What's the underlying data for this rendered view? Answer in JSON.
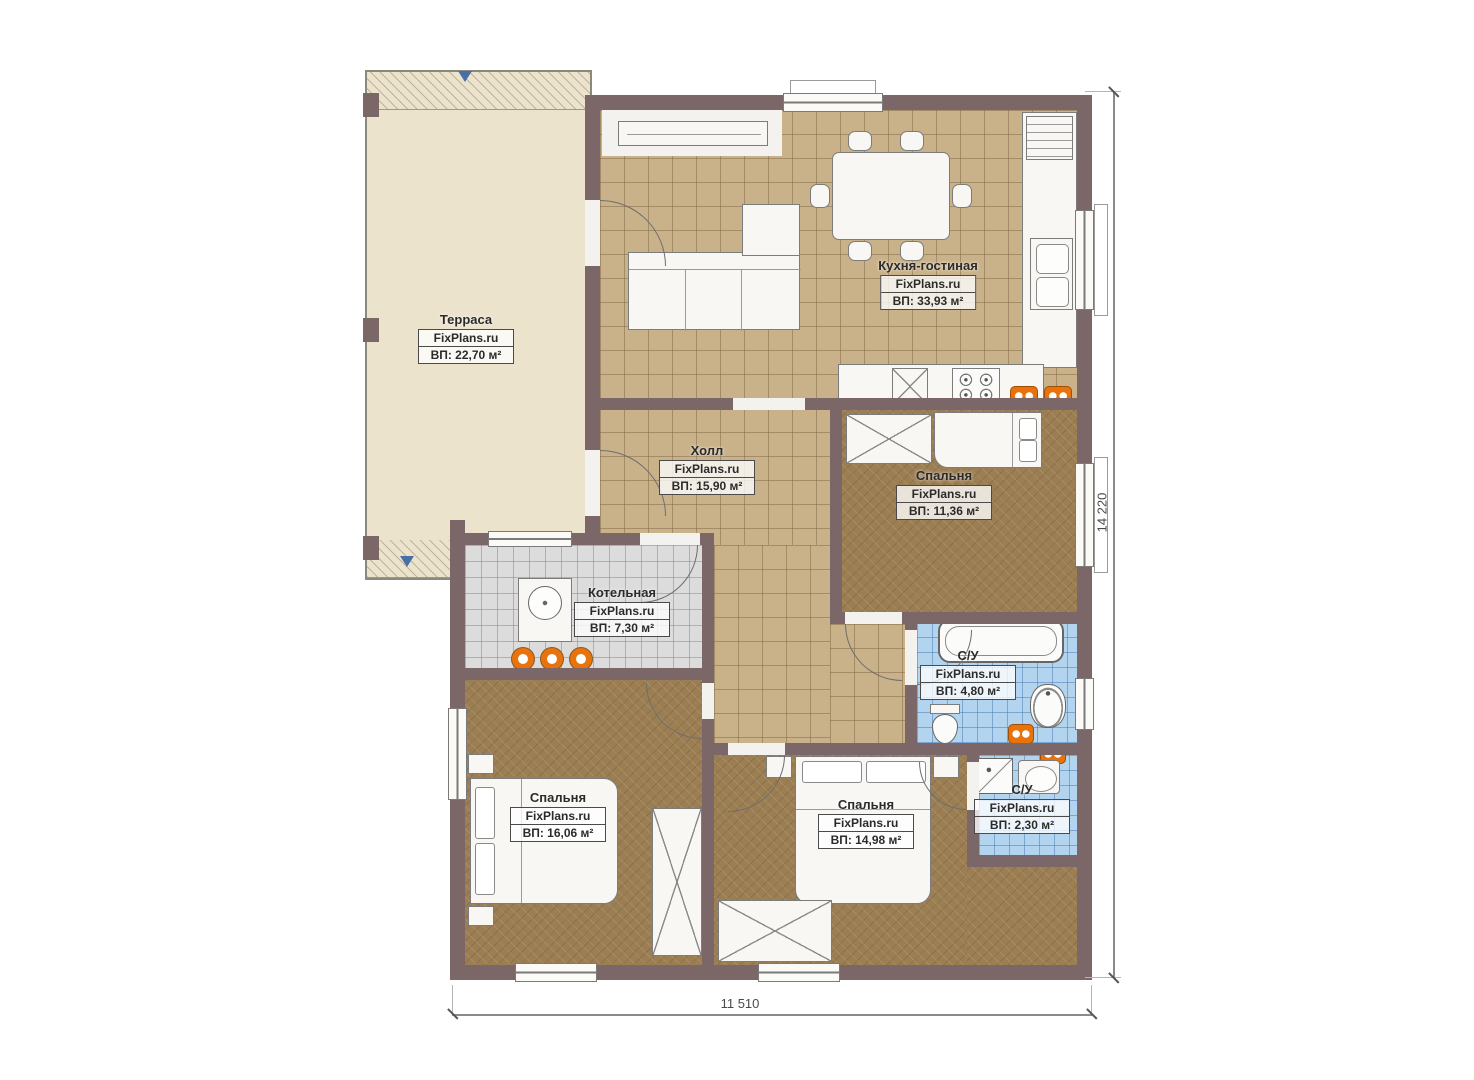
{
  "plan": {
    "watermark": "FixPlans.ru",
    "rooms": [
      {
        "id": "terrace",
        "name": "Терраса",
        "area": "ВП: 22,70 м²"
      },
      {
        "id": "kitchen",
        "name": "Кухня-гостиная",
        "area": "ВП: 33,93 м²"
      },
      {
        "id": "hall",
        "name": "Холл",
        "area": "ВП: 15,90 м²"
      },
      {
        "id": "bedroom1",
        "name": "Спальня",
        "area": "ВП: 11,36 м²"
      },
      {
        "id": "boiler",
        "name": "Котельная",
        "area": "ВП: 7,30 м²"
      },
      {
        "id": "bath1",
        "name": "С/У",
        "area": "ВП: 4,80 м²"
      },
      {
        "id": "bedroom2",
        "name": "Спальня",
        "area": "ВП: 16,06 м²"
      },
      {
        "id": "bedroom3",
        "name": "Спальня",
        "area": "ВП: 14,98 м²"
      },
      {
        "id": "bath2",
        "name": "С/У",
        "area": "ВП: 2,30 м²"
      }
    ],
    "dimensions": {
      "height": "14 220",
      "width": "11 510"
    },
    "colors": {
      "wall": "#7b6768",
      "floor_tile": "#c9b189",
      "floor_wood": "#9c7e53",
      "tile_blue": "#b3d4ee",
      "tile_gray": "#dcdcdc",
      "terrace": "#ece3cd",
      "accent_orange": "#e8720c",
      "marker_blue": "#4a6fa5"
    }
  }
}
